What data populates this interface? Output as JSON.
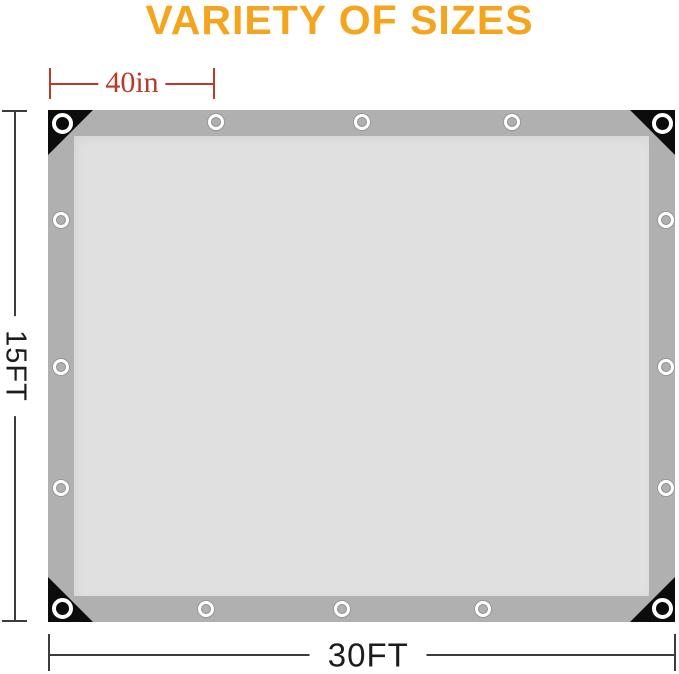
{
  "title": {
    "text": "VARIETY OF SIZES"
  },
  "dimensions": {
    "top_width": {
      "label": "40in"
    },
    "height": {
      "label": "15FT"
    },
    "bottom_width": {
      "label": "30FT"
    }
  },
  "colors": {
    "accent": "#F5A41E",
    "dim-red": "#BD3927",
    "ink": "#1C1C1C",
    "line": "#3C3C3C",
    "tarp-border": "#B0B0B0",
    "tarp-interior": "#E0E0E0",
    "corner": "#0C0C0C",
    "grommet-ring": "#FFFFFF"
  },
  "tarp": {
    "corner_reinforcement_count": 4,
    "grommets": [
      {
        "pos": "corner-top-left",
        "cx": 14,
        "cy": 13,
        "d": 21
      },
      {
        "pos": "corner-top-right",
        "cx": 614,
        "cy": 13,
        "d": 21
      },
      {
        "pos": "corner-bottom-left",
        "cx": 14,
        "cy": 498,
        "d": 21
      },
      {
        "pos": "corner-bottom-right",
        "cx": 614,
        "cy": 498,
        "d": 21
      },
      {
        "pos": "top-1",
        "cx": 168,
        "cy": 12,
        "d": 16
      },
      {
        "pos": "top-2",
        "cx": 314,
        "cy": 12,
        "d": 16
      },
      {
        "pos": "top-3",
        "cx": 464,
        "cy": 12,
        "d": 16
      },
      {
        "pos": "bottom-1",
        "cx": 158,
        "cy": 499,
        "d": 16
      },
      {
        "pos": "bottom-2",
        "cx": 294,
        "cy": 499,
        "d": 16
      },
      {
        "pos": "bottom-3",
        "cx": 435,
        "cy": 499,
        "d": 16
      },
      {
        "pos": "left-1",
        "cx": 13,
        "cy": 110,
        "d": 16
      },
      {
        "pos": "left-2",
        "cx": 13,
        "cy": 257,
        "d": 16
      },
      {
        "pos": "left-3",
        "cx": 13,
        "cy": 378,
        "d": 16
      },
      {
        "pos": "right-1",
        "cx": 618,
        "cy": 110,
        "d": 16
      },
      {
        "pos": "right-2",
        "cx": 618,
        "cy": 257,
        "d": 16
      },
      {
        "pos": "right-3",
        "cx": 618,
        "cy": 378,
        "d": 16
      }
    ]
  }
}
